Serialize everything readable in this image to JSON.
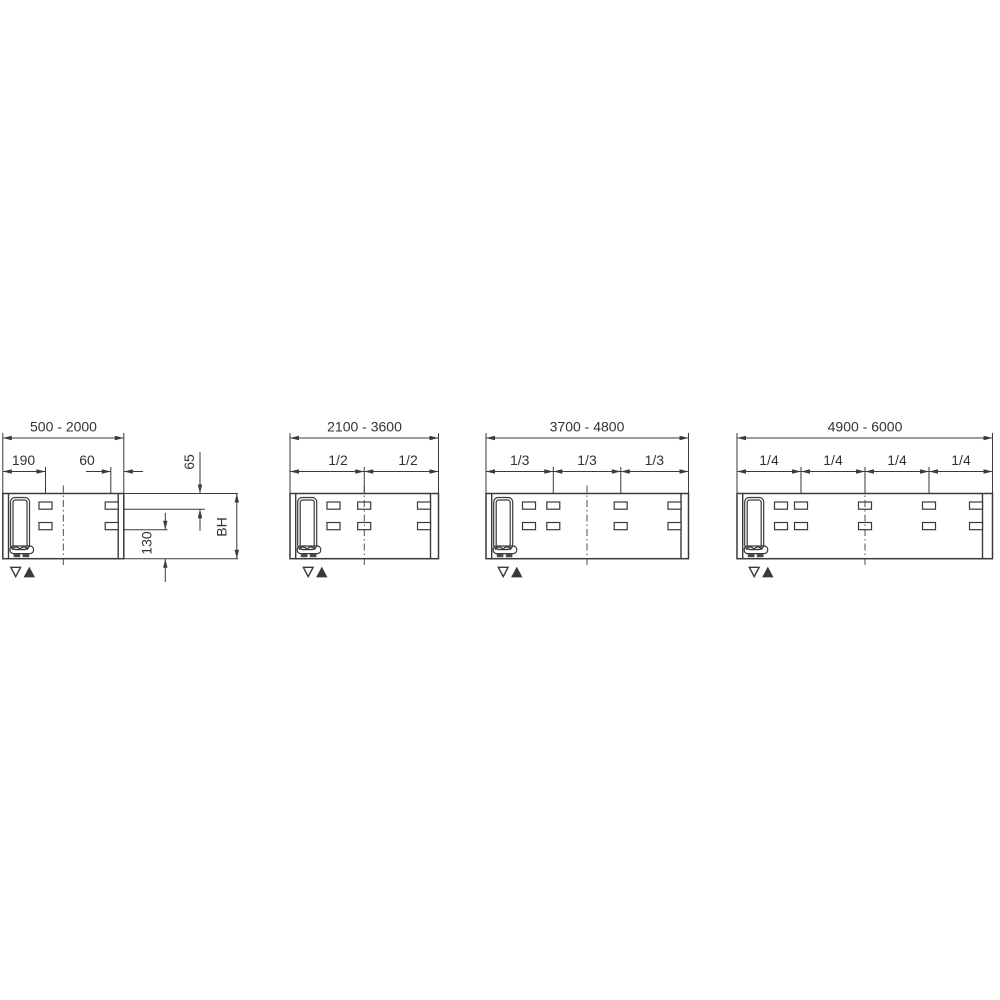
{
  "drawing": {
    "type": "technical-installation-diagram",
    "background_color": "#ffffff",
    "line_color": "#3a3a3a",
    "text_color": "#333333",
    "markers_legend": [
      "triangle-down-outline",
      "triangle-up-filled"
    ]
  },
  "diagrams": [
    {
      "name": "panel-500-2000",
      "range_label": "500 - 2000",
      "dim_labels": {
        "left_slot_offset": "190",
        "right_slot_offset": "60",
        "top_slot_offset": "65",
        "bottom_slot_offset": "130",
        "body_height": "BH"
      },
      "markers": [
        "triangle-down-outline",
        "triangle-up-filled"
      ]
    },
    {
      "name": "panel-2100-3600",
      "range_label": "2100 - 3600",
      "fractions": [
        "1/2",
        "1/2"
      ],
      "markers": [
        "triangle-down-outline",
        "triangle-up-filled"
      ]
    },
    {
      "name": "panel-3700-4800",
      "range_label": "3700 - 4800",
      "fractions": [
        "1/3",
        "1/3",
        "1/3"
      ],
      "markers": [
        "triangle-down-outline",
        "triangle-up-filled"
      ]
    },
    {
      "name": "panel-4900-6000",
      "range_label": "4900 - 6000",
      "fractions": [
        "1/4",
        "1/4",
        "1/4",
        "1/4"
      ],
      "markers": [
        "triangle-down-outline",
        "triangle-up-filled"
      ]
    }
  ]
}
